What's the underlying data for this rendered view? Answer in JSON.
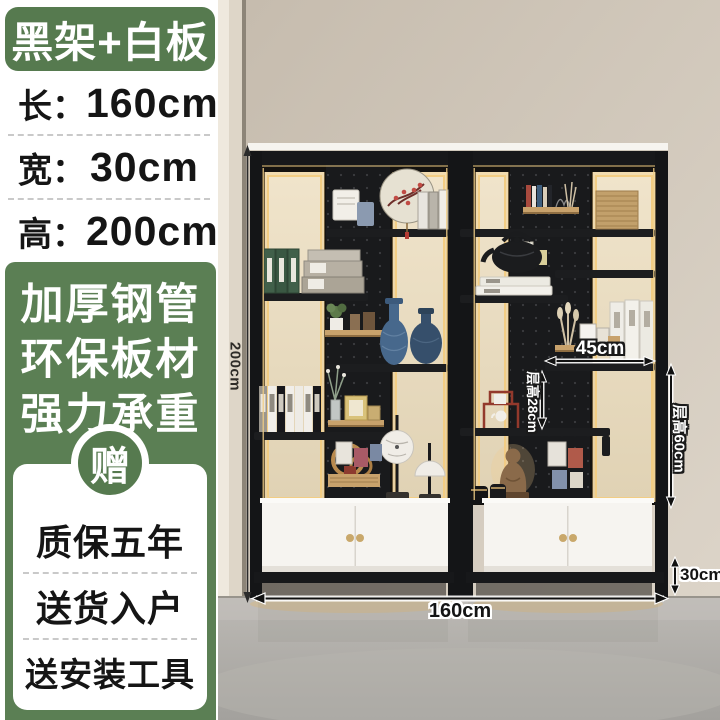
{
  "sidebar": {
    "variant_badge": "黑架+白板",
    "size_rows": [
      {
        "label": "长：",
        "value": "160cm"
      },
      {
        "label": "宽：",
        "value": "30cm"
      },
      {
        "label": "高：",
        "value": "200cm"
      }
    ],
    "feature_lines": [
      "加厚钢管",
      "环保板材",
      "强力承重"
    ],
    "gift_circle": "赠",
    "service_rows": [
      "质保五年",
      "送货入户",
      "送安装工具"
    ]
  },
  "photo": {
    "annotations": {
      "total_height": "200cm",
      "shelf_span": "45cm",
      "tier_height_small": "层高28cm",
      "tier_height_large": "层高60cm",
      "base_height": "30cm",
      "total_width": "160cm"
    }
  },
  "colors": {
    "badge_green": "#567a4f",
    "panel_green": "#5b7f54",
    "led_gold": "#f2cd84",
    "frame_black": "#17181a",
    "cabinet_white": "#f6f4f0",
    "wall_beige": "#cdc3b6",
    "floor_grey": "#b0aeaa"
  }
}
